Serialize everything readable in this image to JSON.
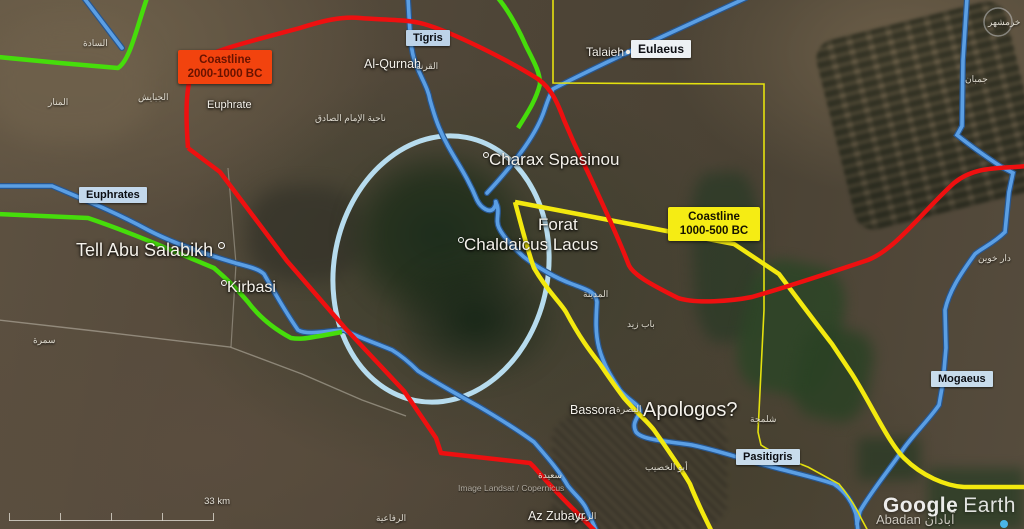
{
  "colors": {
    "red_line": "#ee1010",
    "green_line": "#46dd0b",
    "river_blue": "#5b9fe4",
    "river_blue_dark": "#27568f",
    "pale_blue": "#b7dcee",
    "yellow_line": "#f3e90f",
    "survey_yellow": "#e4e10e",
    "road_gray": "#d8d2c6",
    "ring_white": "#d6dade",
    "dot_blue": "#49b6e8"
  },
  "legend": {
    "ancient": {
      "line1": "Coastline",
      "line2": "2000-1000 BC",
      "bg": "#f2430e",
      "text": "#691300"
    },
    "classical": {
      "line1": "Coastline",
      "line2": "1000-500 BC",
      "bg": "#f5ec14",
      "text": "#161300"
    }
  },
  "river_tags": {
    "tigris": "Tigris",
    "eulaeus": "Eulaeus",
    "euphrates": "Euphrates",
    "pasitigris": "Pasitigris",
    "mogaeus": "Mogaeus"
  },
  "places": {
    "euphrate_river_text": "Euphrate",
    "al_qurnah": "Al-Qurnah",
    "talaieh": "Talaieh",
    "tell_abu_salabikh": "Tell Abu Salabikh",
    "kirbasi": "Kirbasi",
    "charax": "Charax Spasinou",
    "forat": "Forat",
    "chaldaicus": "Chaldaicus Lacus",
    "bassora": "Bassora",
    "apologos": "Apologos?",
    "az_zubayr": "Az Zubayr",
    "abadan": "Abadan"
  },
  "arabic": {
    "al_sada": "السادة",
    "al_manar": "المنار",
    "al_jabayish": "الجبايش",
    "al_qurnah": "القرنة",
    "nahiyat_imam": "ناحية الإمام الصادق",
    "al_madina": "المدينة",
    "bab_zaid": "باب زيد",
    "shalamja": "شلمجة",
    "abu_al_khasib": "أبو الخصيب",
    "basra": "البصرة",
    "zubair": "الزبير",
    "saida": "سعيدة",
    "rifaiya": "الرفاعية",
    "dar_khoein": "دار خوین",
    "jomban": "جمبان",
    "khorramshahr": "خرمشهر",
    "samra": "سمرة",
    "abadan": "آبادان"
  },
  "footer": {
    "attribution": "Image Landsat / Copernicus",
    "scale": "33 km",
    "google": "Google",
    "earth": "Earth"
  }
}
